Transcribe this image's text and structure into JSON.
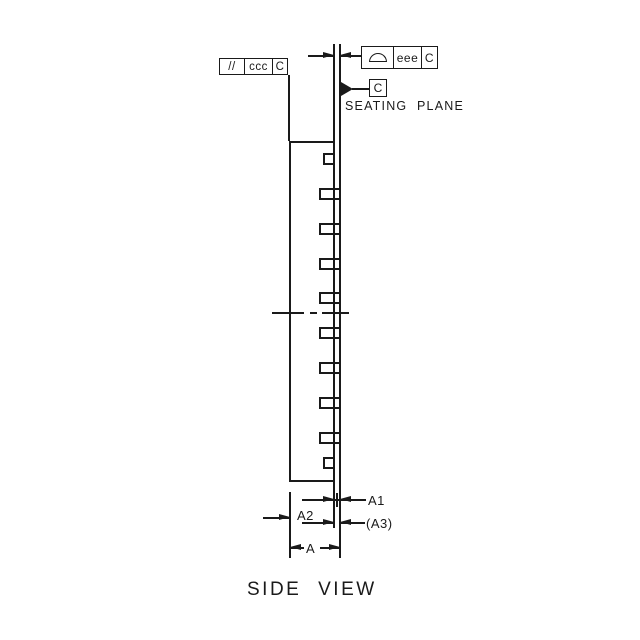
{
  "drawing": {
    "view_title": "SIDE VIEW",
    "seating_plane": {
      "label": "SEATING PLANE",
      "datum_letter": "C"
    },
    "fcf_parallelism": {
      "symbol_text": "//",
      "tolerance": "ccc",
      "datum": "C"
    },
    "fcf_profile": {
      "symbol_icon": "profile-of-surface-icon",
      "tolerance": "eee",
      "datum": "C"
    },
    "dim_labels": {
      "a1": "A1",
      "a2": "A2",
      "a3": "(A3)",
      "a": "A"
    },
    "colors": {
      "line": "#1a1a1a",
      "background": "#ffffff"
    },
    "leads": {
      "count": 10,
      "tab_tops": [
        188,
        223,
        258,
        292,
        327,
        362,
        397,
        432
      ],
      "square_tops": [
        153,
        457
      ]
    }
  }
}
